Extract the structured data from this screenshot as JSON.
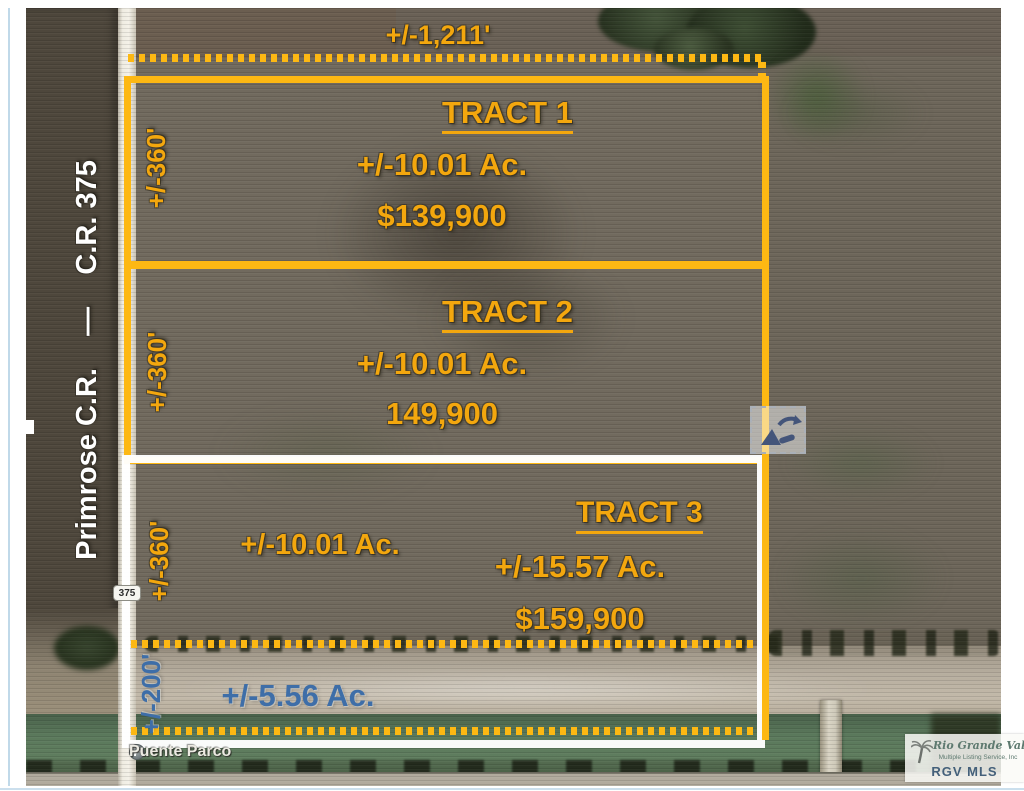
{
  "colors": {
    "annotation_yellow": "#F3A70E",
    "line_yellow": "#FDB813",
    "annotation_blue": "#3E6EA8",
    "logo_teal": "#5E7A70",
    "logo_blue": "#44607A"
  },
  "overlay": {
    "top_width_label": "+/-1,211'",
    "tracts": [
      {
        "name": "TRACT 1",
        "acreage": "+/-10.01 Ac.",
        "price": "$139,900",
        "depth_label": "+/-360'"
      },
      {
        "name": "TRACT 2",
        "acreage": "+/-10.01 Ac.",
        "price": "149,900",
        "depth_label": "+/-360'"
      },
      {
        "name": "TRACT 3",
        "acreage": "+/-15.57 Ac.",
        "price": "$159,900",
        "depth_label": "+/-360'",
        "secondary_acreage": "+/-10.01 Ac."
      }
    ],
    "bottom_strip": {
      "acreage": "+/-5.56 Ac.",
      "depth_label": "+/-200'"
    }
  },
  "map": {
    "left_road_label": "Primrose C.R.    —    C.R. 375",
    "route_shield": "375",
    "bottom_road_label": "Puente Parco"
  },
  "watermark_logo": {
    "name_script": "Rio Grande Valley",
    "subtitle": "Multiple Listing Service, Inc",
    "abbr": "RGV MLS"
  }
}
